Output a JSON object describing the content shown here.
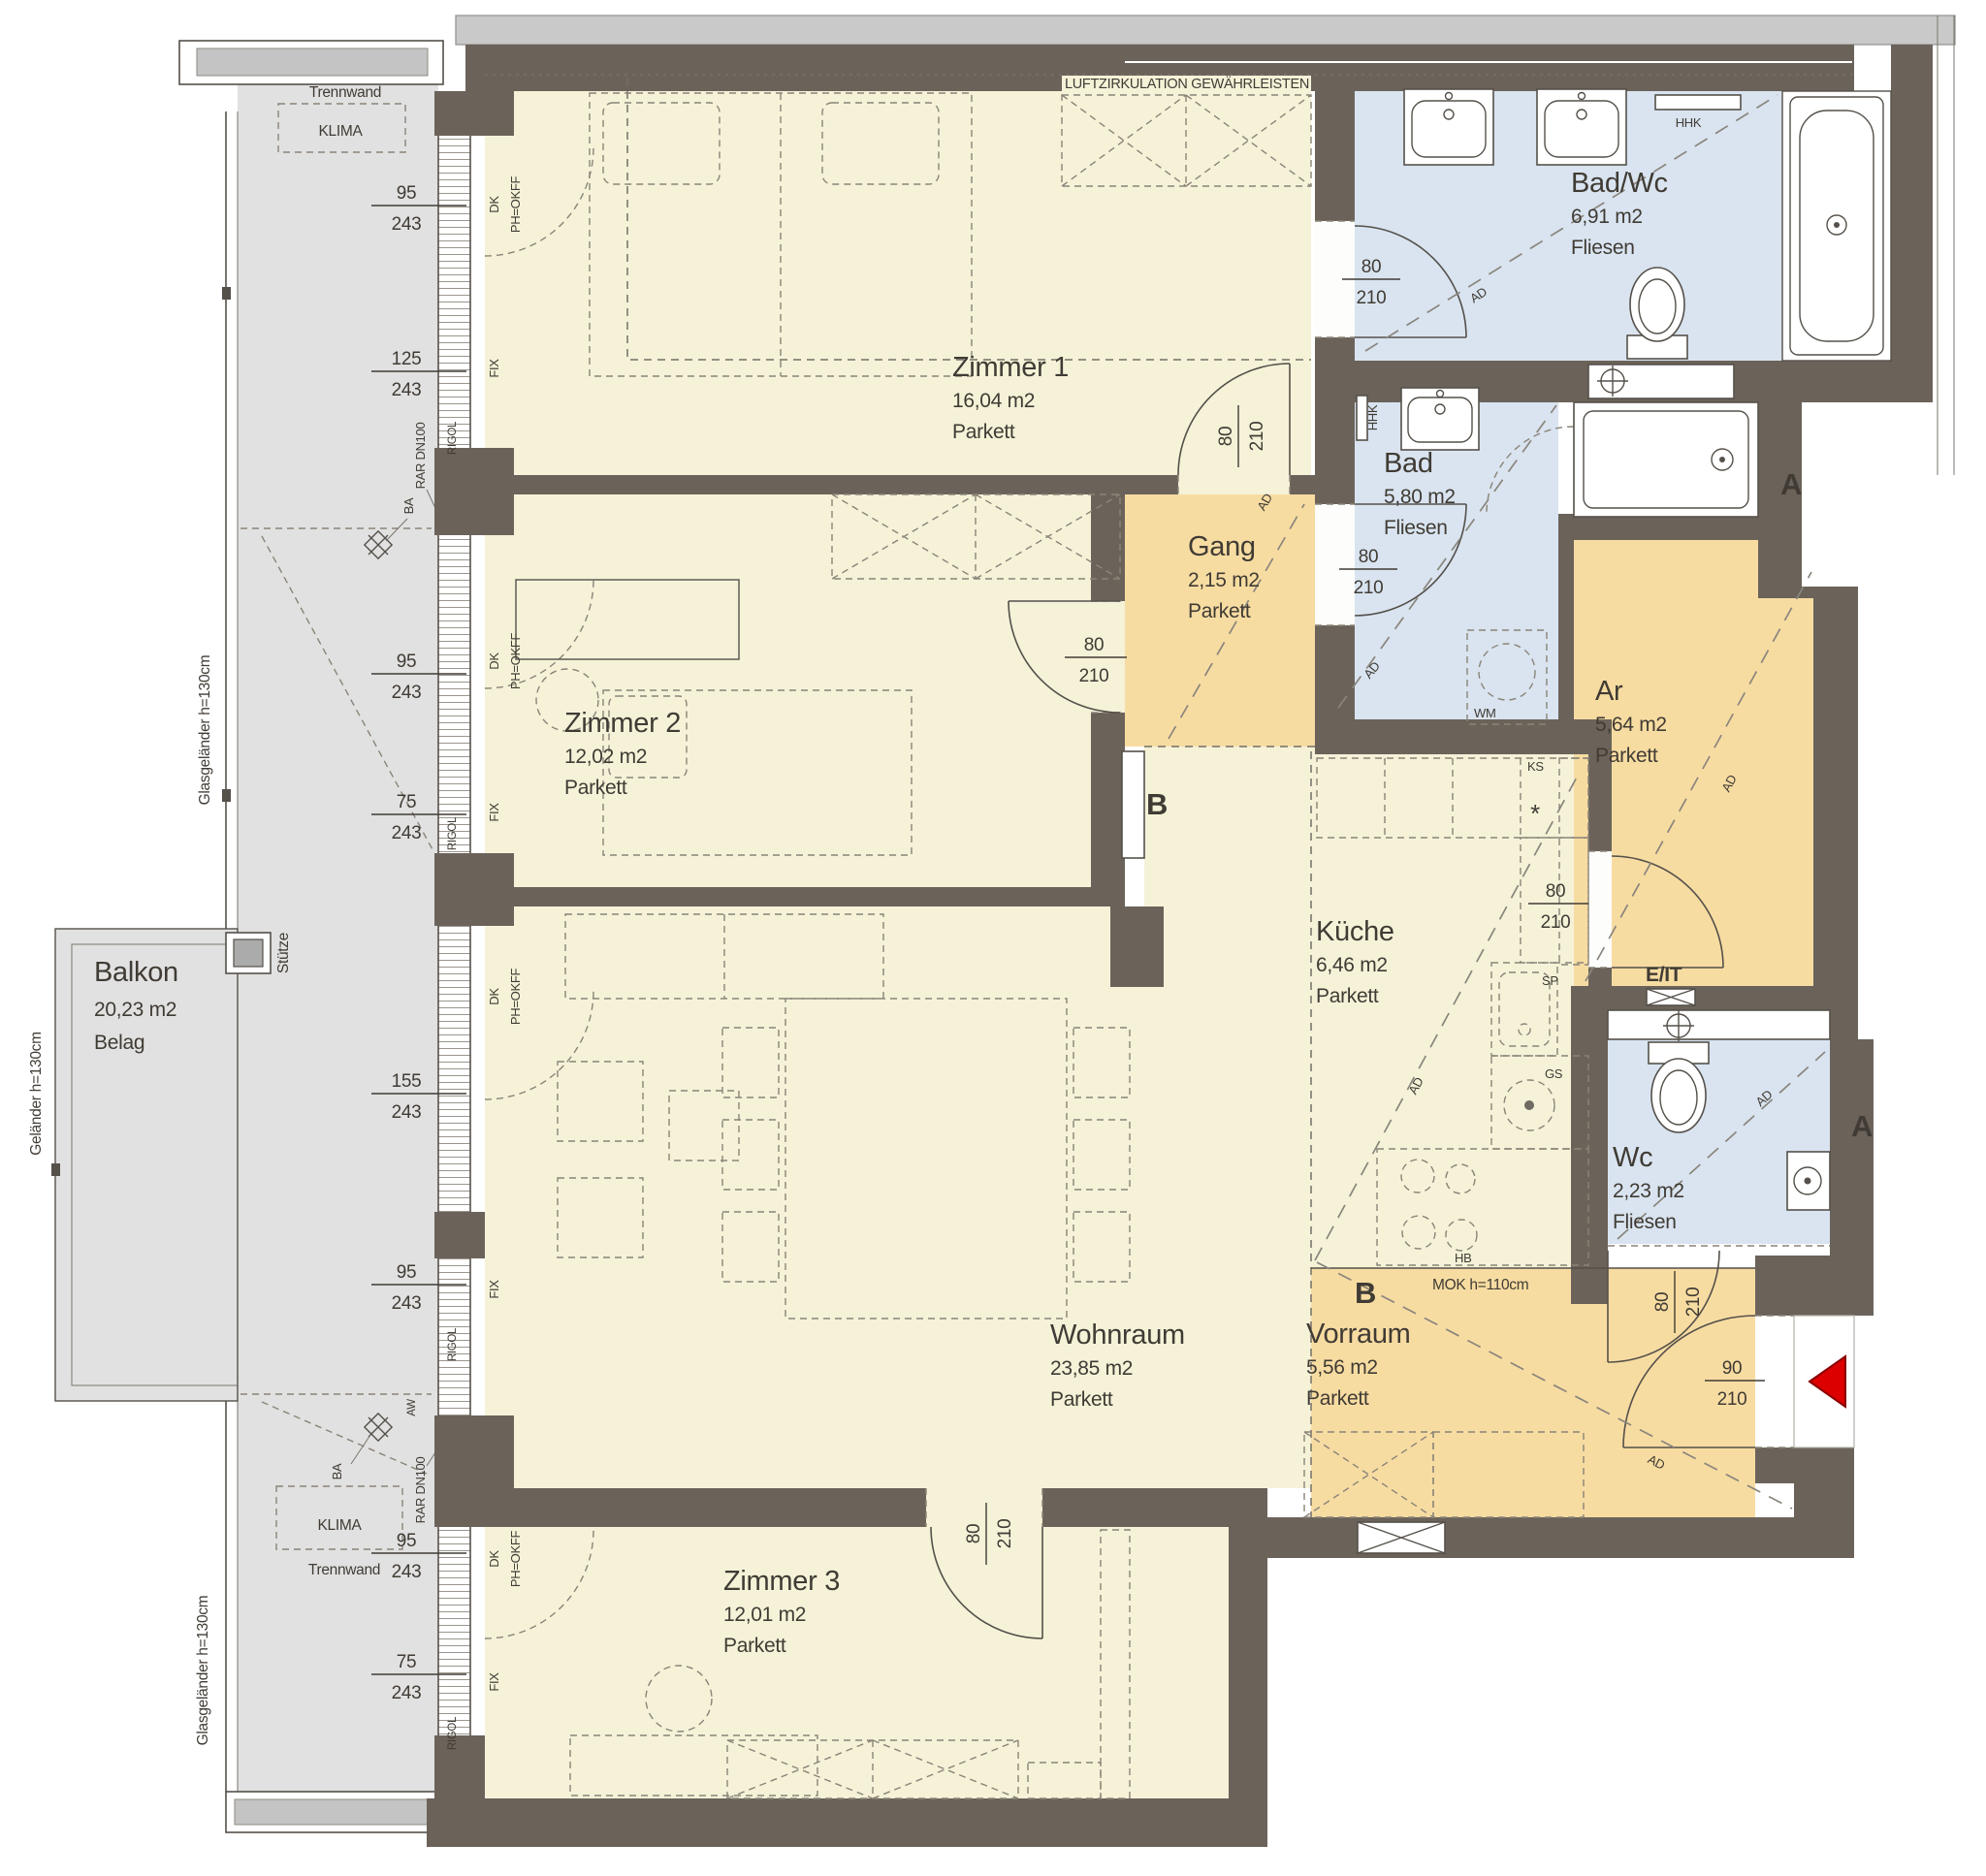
{
  "title": "Wohnungsplan",
  "colors": {
    "room_cream": "#f5f2d8",
    "hall_orange": "#f7dca2",
    "bath_blue": "#d9e4f0",
    "balcony_gray": "#e1e1e1",
    "wall_dark": "#6b635a",
    "arrow_red": "#dd0000"
  },
  "rooms": [
    {
      "name": "Zimmer 1",
      "area": "16,04  m2",
      "floor": "Parkett"
    },
    {
      "name": "Zimmer 2",
      "area": "12,02 m2",
      "floor": "Parkett"
    },
    {
      "name": "Zimmer 3",
      "area": "12,01  m2",
      "floor": "Parkett"
    },
    {
      "name": "Wohnraum",
      "area": "23,85 m2",
      "floor": "Parkett"
    },
    {
      "name": "Küche",
      "area": "6,46   m2",
      "floor": "Parkett"
    },
    {
      "name": "Gang",
      "area": "2,15   m2",
      "floor": "Parkett"
    },
    {
      "name": "Vorraum",
      "area": "5,56   m2",
      "floor": "Parkett"
    },
    {
      "name": "Bad/Wc",
      "area": "6,91   m2",
      "floor": "Fliesen"
    },
    {
      "name": "Bad",
      "area": "5,80   m2",
      "floor": "Fliesen"
    },
    {
      "name": "Wc",
      "area": "2,23   m2",
      "floor": "Fliesen"
    },
    {
      "name": "Ar",
      "area": "5,64   m2",
      "floor": "Parkett"
    },
    {
      "name": "Balkon",
      "area": "20,23 m2",
      "floor": "Belag"
    }
  ],
  "window_dims": [
    {
      "w": "95",
      "h": "243"
    },
    {
      "w": "125",
      "h": "243"
    },
    {
      "w": "95",
      "h": "243"
    },
    {
      "w": "75",
      "h": "243"
    },
    {
      "w": "155",
      "h": "243"
    },
    {
      "w": "95",
      "h": "243"
    },
    {
      "w": "95",
      "h": "243"
    },
    {
      "w": "75",
      "h": "243"
    }
  ],
  "door_dims": [
    {
      "w": "80",
      "h": "210"
    },
    {
      "w": "80",
      "h": "210"
    },
    {
      "w": "80",
      "h": "210"
    },
    {
      "w": "80",
      "h": "210"
    },
    {
      "w": "80",
      "h": "210"
    },
    {
      "w": "80",
      "h": "210"
    },
    {
      "w": "80",
      "h": "210"
    },
    {
      "w": "90",
      "h": "210"
    }
  ],
  "labels": {
    "luft": "LUFTZIRKULATION GEWÄHRLEISTEN",
    "trennwand": "Trennwand",
    "klima": "KLIMA",
    "stuetze": "Stütze",
    "gelaender": "Geländer  h=130cm",
    "glasgelaender": "Glasgeländer  h=130cm",
    "mok": "MOK  h=110cm",
    "eit": "E/IT",
    "section_a": "A",
    "section_b": "B"
  },
  "fixture_labels": {
    "hhk": "HHK",
    "wm": "WM",
    "sp": "SP",
    "gs": "GS",
    "ks": "KS",
    "hb": "HB",
    "ad": "AD",
    "ba": "BA",
    "rar": "RAR DN100",
    "aw": "AW",
    "rigol": "RIGOL",
    "dk": "DK",
    "ph": "PH=OKFF",
    "fix": "FIX",
    "star": "*"
  }
}
